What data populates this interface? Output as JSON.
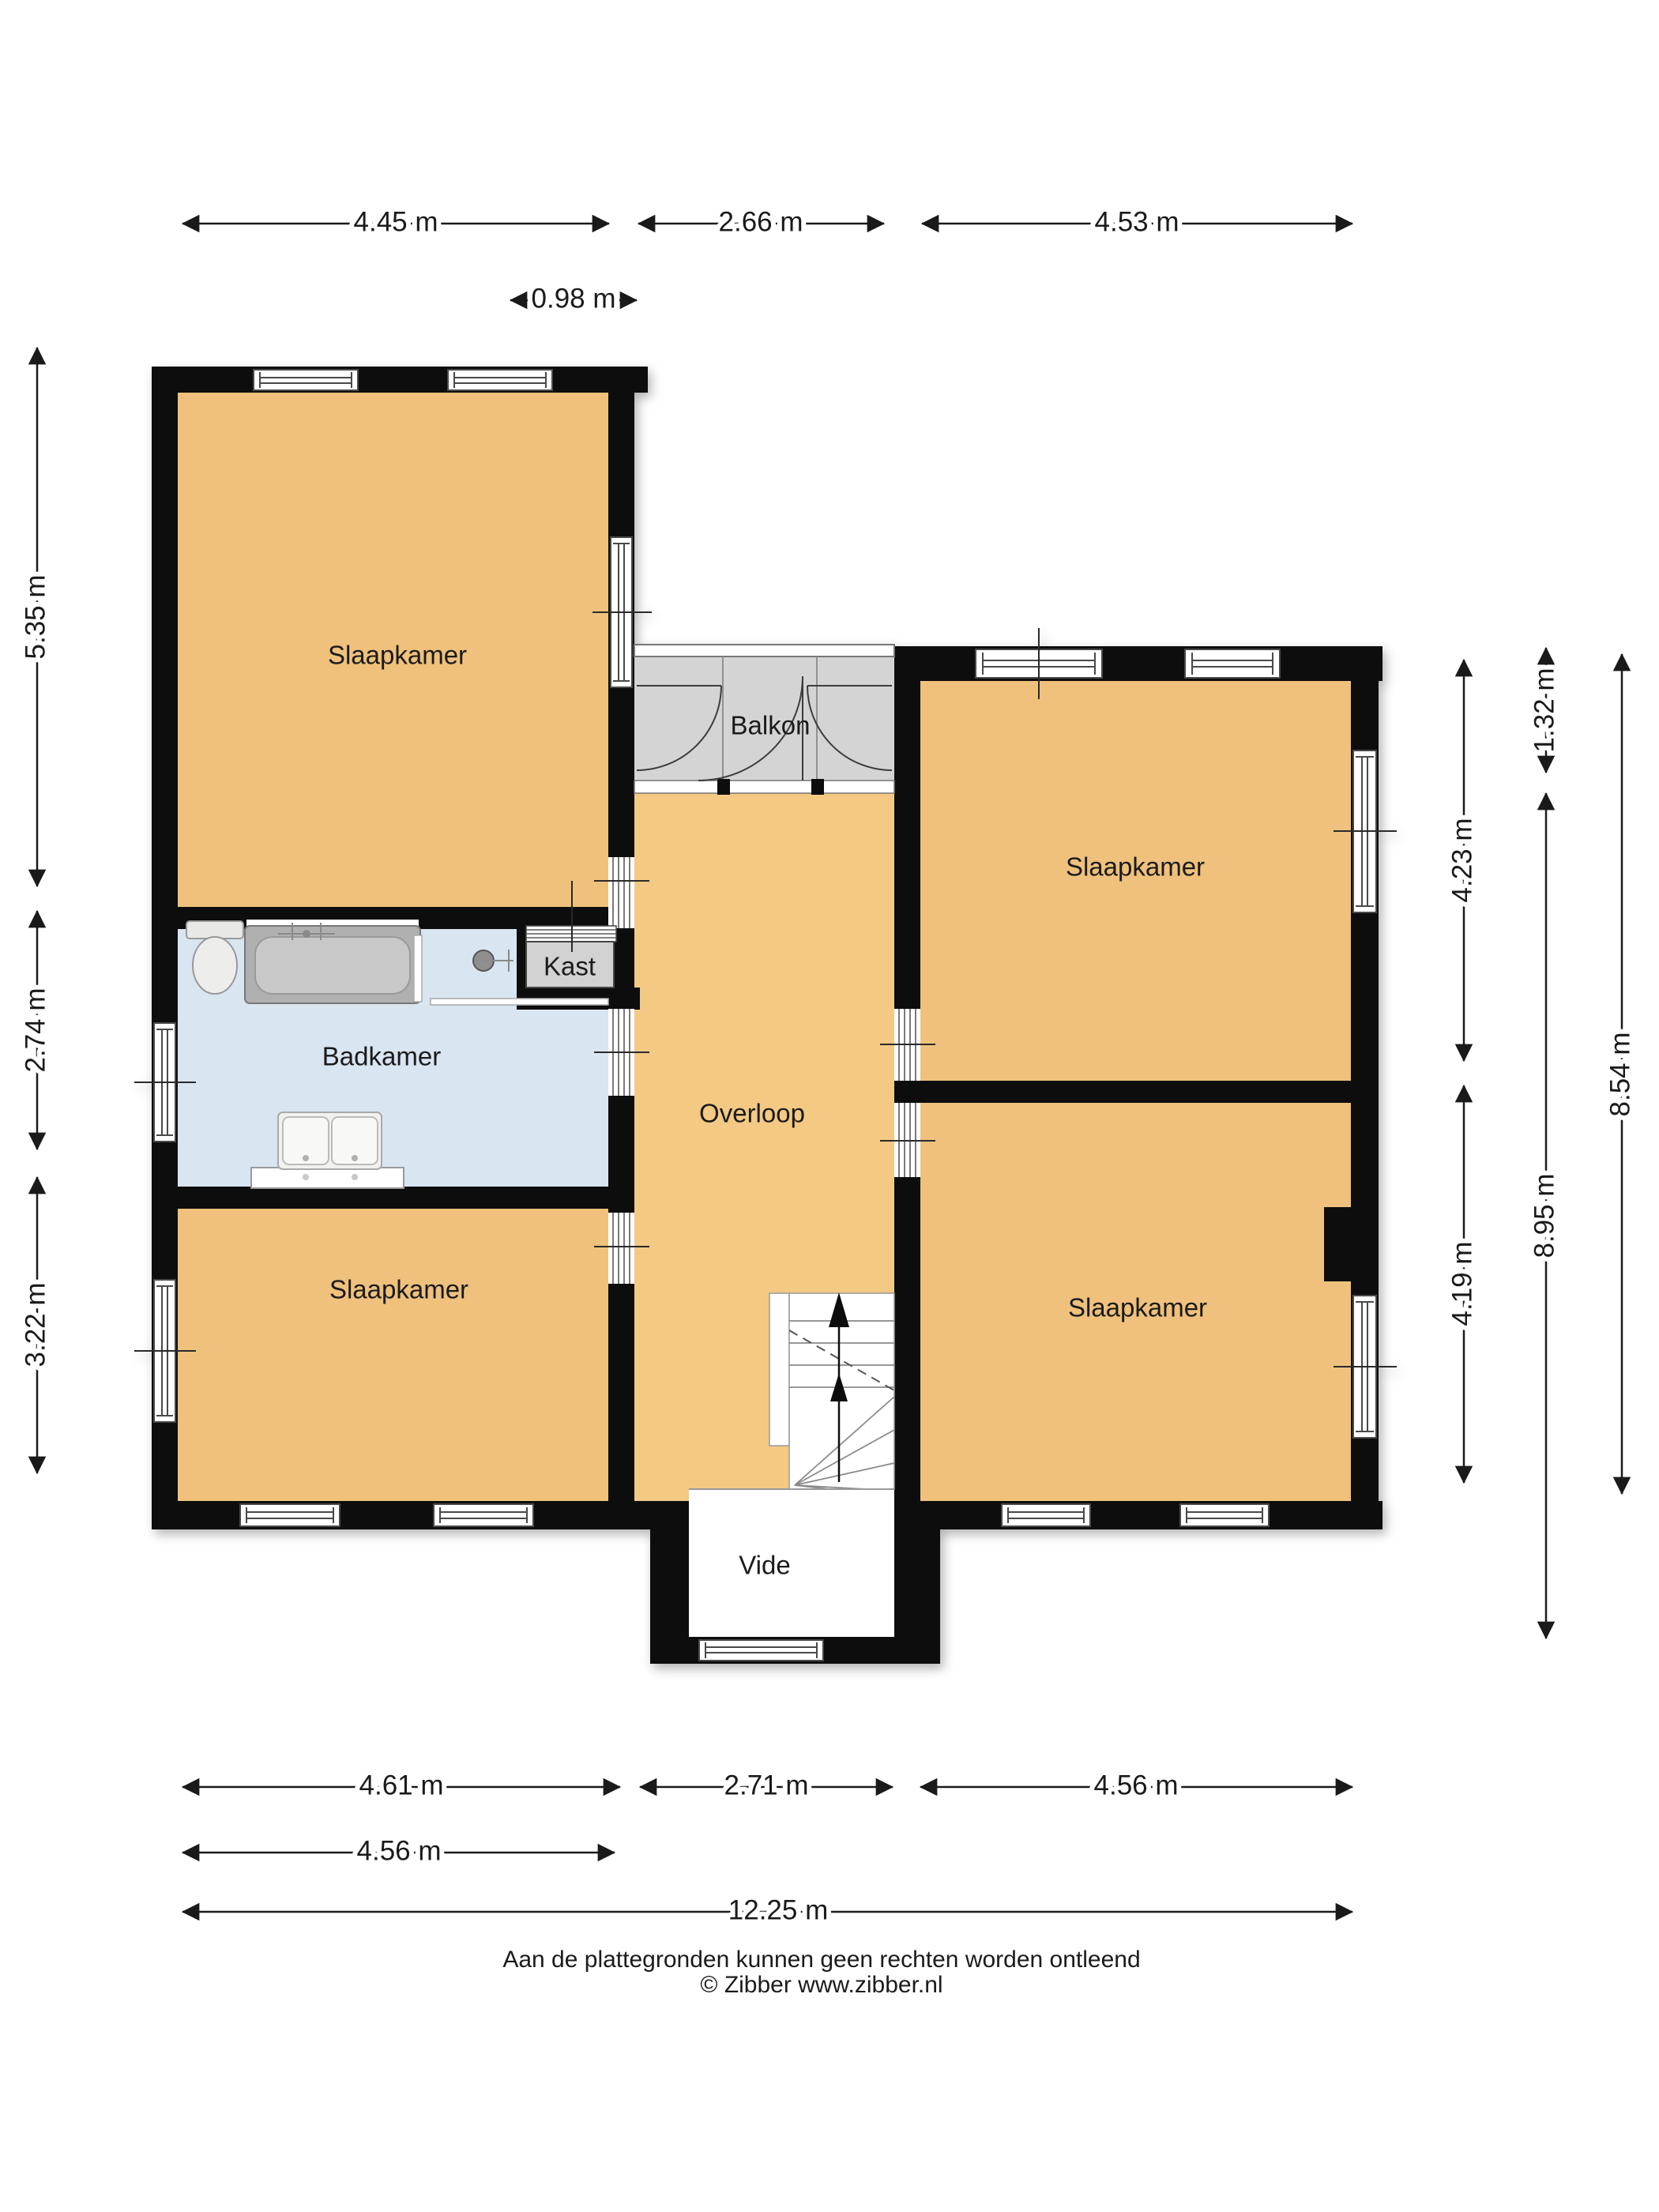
{
  "rooms": {
    "slaapkamer_tl": "Slaapkamer",
    "slaapkamer_tr": "Slaapkamer",
    "slaapkamer_bl": "Slaapkamer",
    "slaapkamer_br": "Slaapkamer",
    "badkamer": "Badkamer",
    "kast": "Kast",
    "balkon": "Balkon",
    "overloop": "Overloop",
    "vide": "Vide"
  },
  "dimensions": {
    "top": {
      "left": "4.45 m",
      "middle": "2.66 m",
      "right": "4.53 m",
      "balcony_inner": "0.98 m"
    },
    "left": {
      "top": "5.35 m",
      "middle": "2.74 m",
      "bottom": "3.22 m"
    },
    "right": {
      "balcony_depth": "1.32 m",
      "room_top": "4.23 m",
      "room_bottom": "4.19 m",
      "inner_total": "8.95 m",
      "outer_total": "8.54 m"
    },
    "bottom": {
      "left": "4.61 m",
      "middle": "2.71 m",
      "right": "4.56 m",
      "left_row2": "4.56 m",
      "total": "12.25 m"
    }
  },
  "footer": {
    "disclaimer": "Aan de plattegronden kunnen geen rechten worden ontleend",
    "copyright": "© Zibber www.zibber.nl"
  },
  "colors": {
    "wall": "#111111",
    "room_fill": "#EFC17C",
    "hallway_fill": "#F3C984",
    "bathroom_fill": "#D9E5F1",
    "balcony_fill": "#D4D4D4",
    "closet_fill": "#D2D2D2",
    "background": "#FFFFFF"
  }
}
